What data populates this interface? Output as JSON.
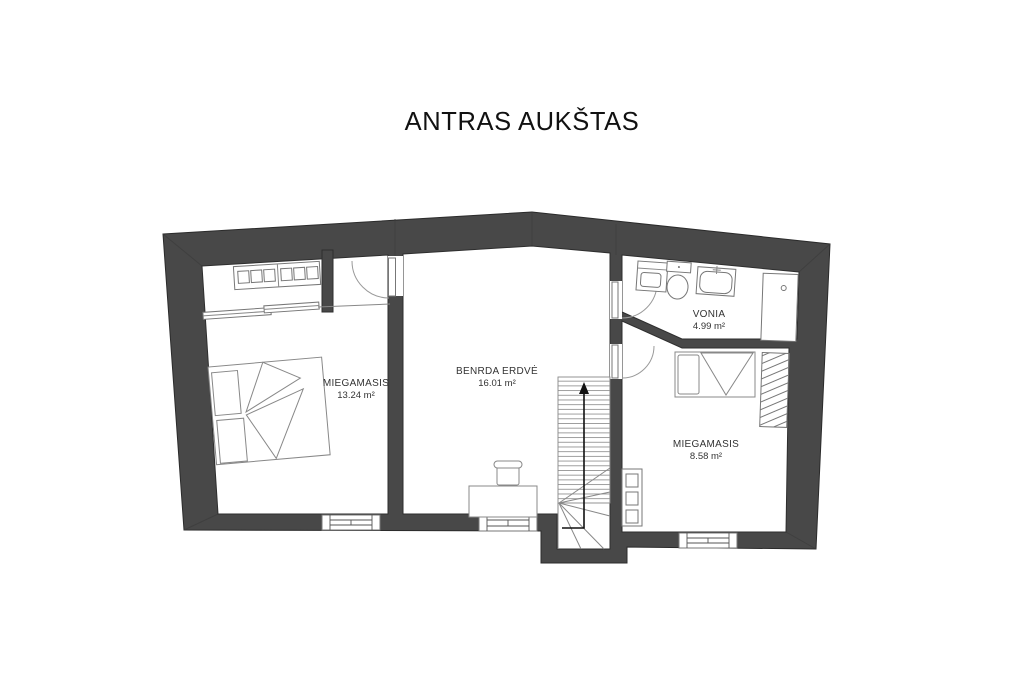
{
  "title": "ANTRAS AUKŠTAS",
  "floor_plan": {
    "rooms": [
      {
        "id": "bedroom-1",
        "name": "MIEGAMASIS",
        "area": "13.24 m²"
      },
      {
        "id": "common-area",
        "name": "BENRDA ERDVĖ",
        "area": "16.01 m²"
      },
      {
        "id": "bathroom",
        "name": "VONIA",
        "area": "4.99 m²"
      },
      {
        "id": "bedroom-2",
        "name": "MIEGAMASIS",
        "area": "8.58 m²"
      }
    ],
    "symbols": {
      "stairs_direction": "up-arrow"
    },
    "colors": {
      "walls": "#484848",
      "background": "#ffffff",
      "furniture_outline": "#888888",
      "label_text": "#333333"
    }
  }
}
